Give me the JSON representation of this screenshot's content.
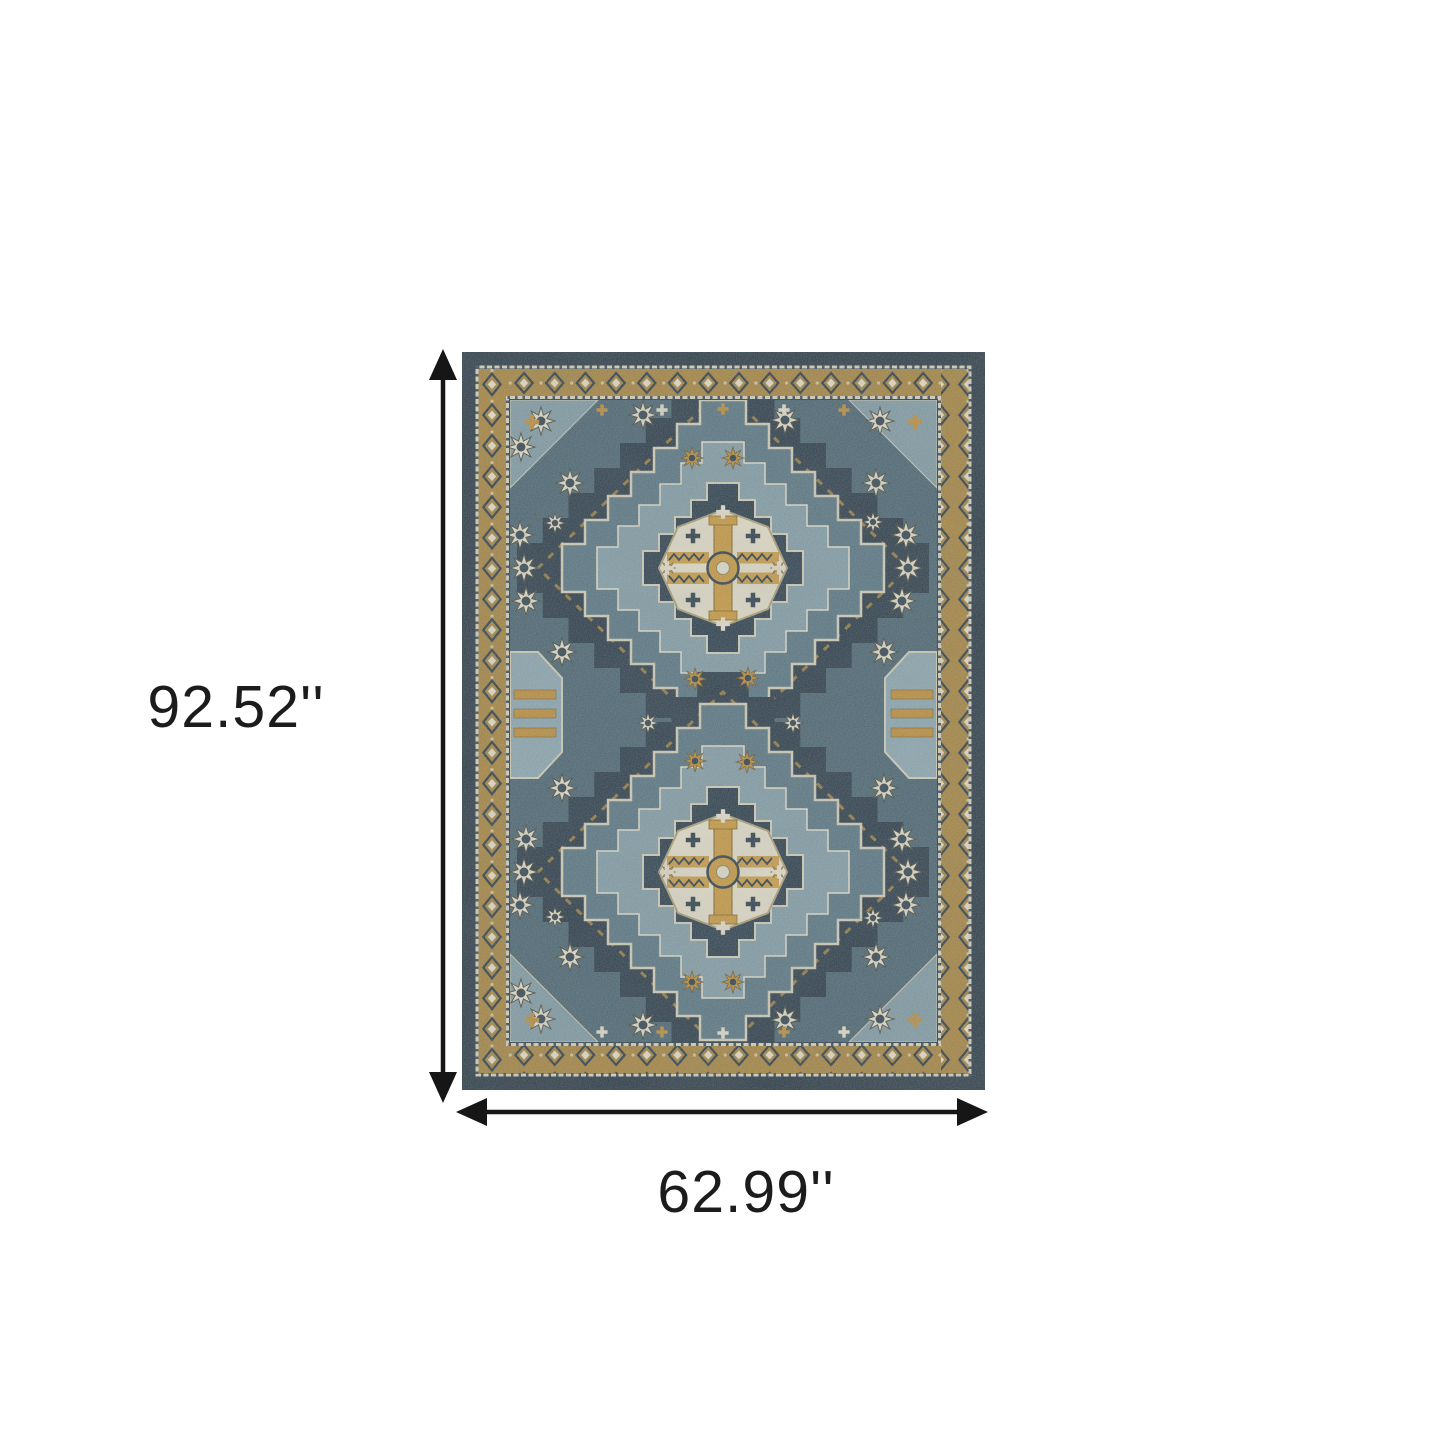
{
  "figure": {
    "type": "product-dimension-diagram",
    "height_label": "92.52''",
    "width_label": "62.99''"
  },
  "style": {
    "background": "#ffffff",
    "arrow_color": "#161616",
    "label_color": "#1c1c1c",
    "rug_palette": {
      "navy": "#2b3b49",
      "slate_blue": "#49626f",
      "light_blue": "#7e97a1",
      "ivory": "#d9d4c2",
      "gold": "#b5893c"
    }
  }
}
